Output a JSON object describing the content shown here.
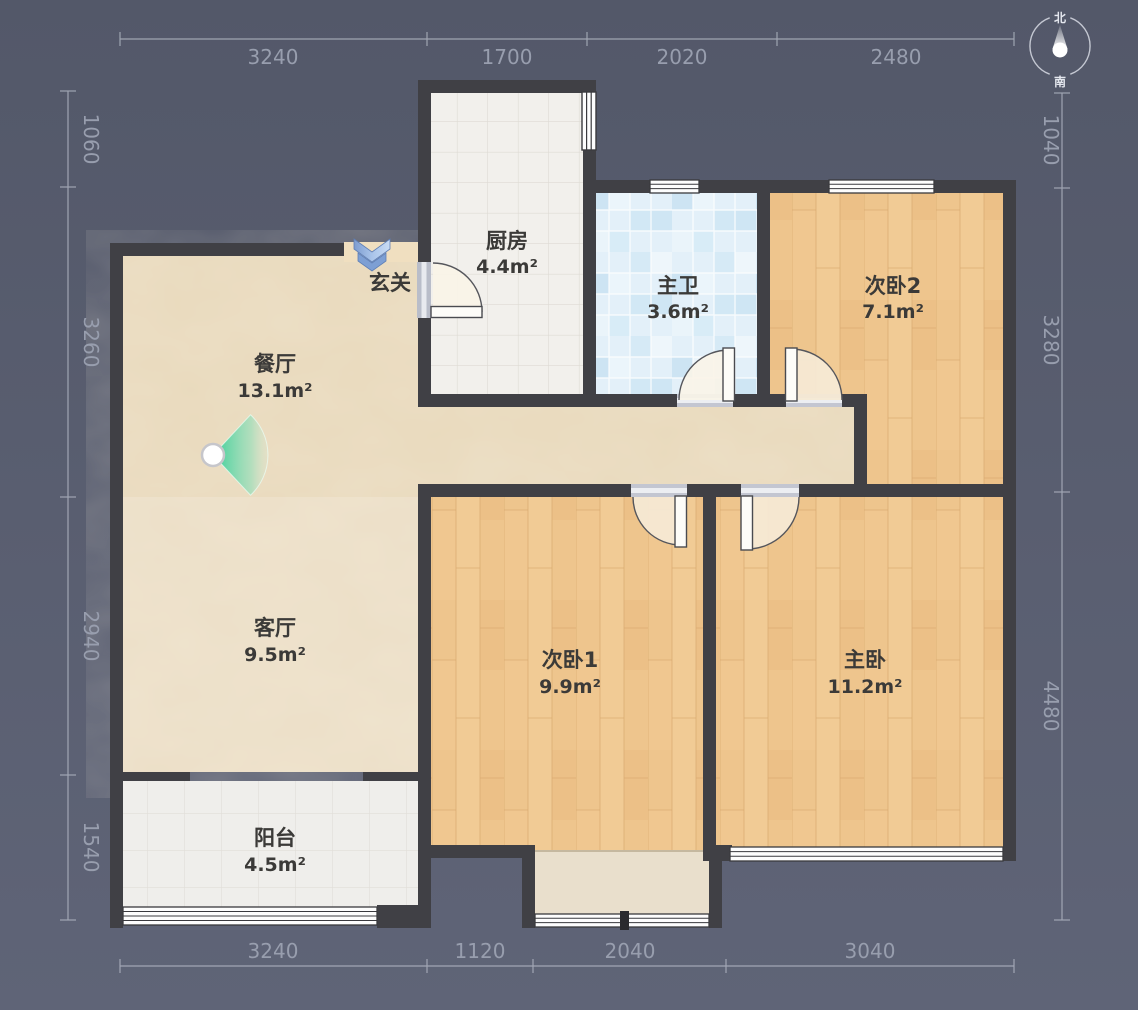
{
  "title": "户型图",
  "compass": {
    "north": "北",
    "south": "南"
  },
  "rooms": {
    "dining": {
      "name": "餐厅",
      "area": "13.1m²"
    },
    "kitchen": {
      "name": "厨房",
      "area": "4.4m²"
    },
    "entry": {
      "name": "玄关",
      "area": ""
    },
    "bath": {
      "name": "主卫",
      "area": "3.6m²"
    },
    "bed2": {
      "name": "次卧2",
      "area": "7.1m²"
    },
    "living": {
      "name": "客厅",
      "area": "9.5m²"
    },
    "bed1": {
      "name": "次卧1",
      "area": "9.9m²"
    },
    "master": {
      "name": "主卧",
      "area": "11.2m²"
    },
    "balcony": {
      "name": "阳台",
      "area": "4.5m²"
    }
  },
  "dims": {
    "top": [
      "3240",
      "1700",
      "2020",
      "2480"
    ],
    "bottom": [
      "3240",
      "1120",
      "2040",
      "3040"
    ],
    "left": [
      "1060",
      "3260",
      "2940",
      "1540"
    ],
    "right": [
      "1040",
      "3280",
      "4480"
    ]
  },
  "colors": {
    "background": "#565b6d",
    "wall": "#404045",
    "marble_floor": "#e9dabd",
    "wood_floor": "#edc28a",
    "bath_tile": "#ddedf8",
    "kitchen_tile": "#f2f0ec",
    "balcony_tile": "#efeeeb",
    "dim_text": "#989eae",
    "accent_teal": "#2ecd94",
    "entry_arrow_blue": "#8fb0de"
  }
}
